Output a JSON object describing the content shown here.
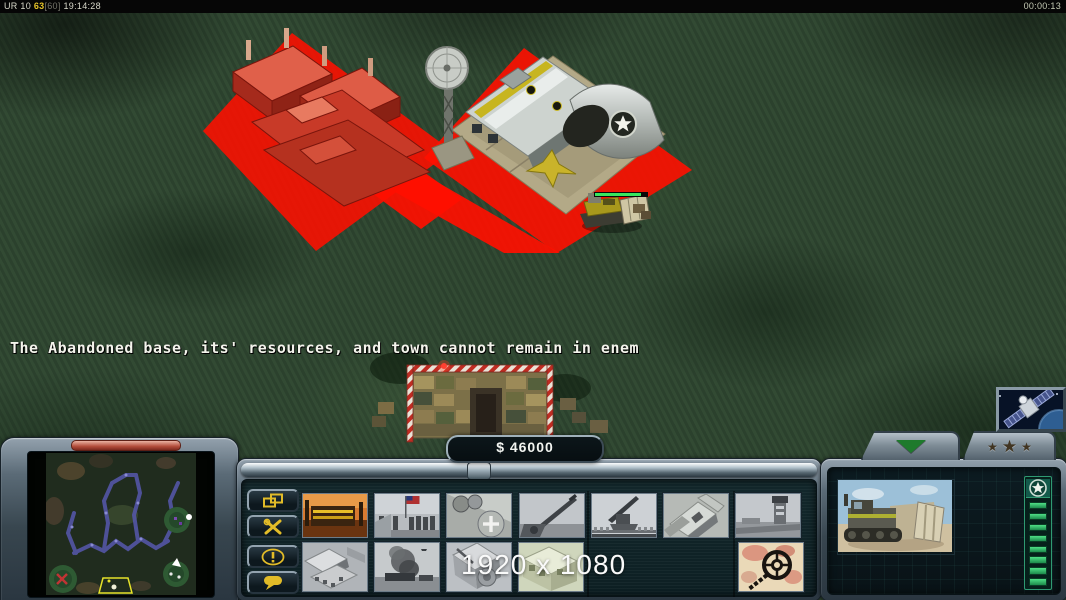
{
  "top_bar": {
    "label": "UR 10",
    "fps": "63",
    "fps_cap": "[60]",
    "clock": "19:14:28",
    "timer": "00:00:13"
  },
  "game": {
    "message": "The Abandoned base, its' resources, and town cannot remain in enem",
    "resolution_overlay": "1920 x 1080",
    "world_objects": [
      "red-placement-zone",
      "abandoned-base-red",
      "airfield-with-radar",
      "construction-dozer",
      "supply-crates-depot"
    ]
  },
  "hud": {
    "money": "$ 46000",
    "side_buttons": [
      {
        "id": "windows",
        "icon": "cascade-windows-icon"
      },
      {
        "id": "repair",
        "icon": "crossed-tools-icon"
      },
      {
        "id": "objectives",
        "icon": "exclamation-icon"
      },
      {
        "id": "chat",
        "icon": "speech-bubble-icon"
      }
    ],
    "build_row1": [
      {
        "icon": "power-plant-photo"
      },
      {
        "icon": "flag-ceremony-photo"
      },
      {
        "icon": "helipad-photo"
      },
      {
        "icon": "artillery-photo"
      },
      {
        "icon": "flak-gun-photo"
      },
      {
        "icon": "factory-aerial-photo"
      },
      {
        "icon": "airfield-tower-photo"
      }
    ],
    "build_row2": [
      {
        "icon": "building-complex-photo"
      },
      {
        "icon": "harbor-smoke-photo"
      },
      {
        "icon": "construction-site-photo"
      },
      {
        "icon": "depot-photo"
      },
      {
        "icon": "minesweeper-map-icon"
      }
    ],
    "right_panel": {
      "star_glyph": "★",
      "health_segments": 8,
      "portrait": "dozer-photo",
      "rank_badge": "star-emblem",
      "collapse_icon": "green-down-arrow-icon",
      "rank_tab_icon": "three-stars-icon"
    },
    "minimap": "tactical-minimap",
    "satellite": "spy-satellite-button"
  },
  "colors": {
    "accent_yellow": "#e2bc28",
    "alert_red": "#ff1000",
    "health_green": "#2fd66e",
    "money_text": "#f2f4f0",
    "hud_teal": "#13282c"
  }
}
